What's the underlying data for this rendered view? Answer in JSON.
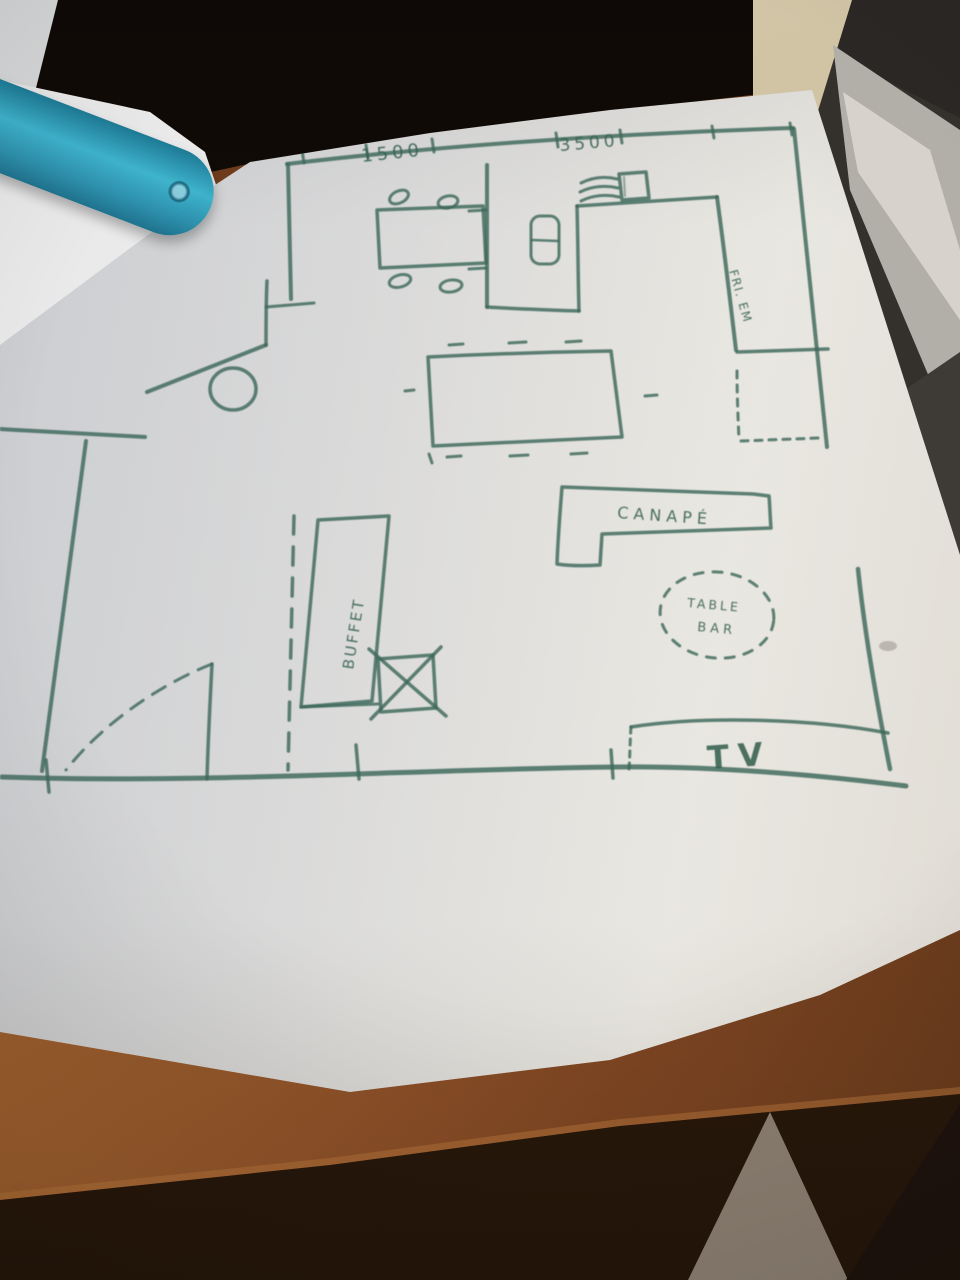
{
  "plan": {
    "ink_color": "#3D685A",
    "dimensions": {
      "top_left": "1500",
      "top_right": "3500"
    },
    "labels": {
      "fridge": "FRI. EM",
      "sofa": "CANAPÉ",
      "table_bar_line1": "TABLE",
      "table_bar_line2": "BAR",
      "buffet": "BUFFET",
      "tv": "TV"
    }
  },
  "scene": {
    "paper_color": "#E2E0DB",
    "wood_color": "#7C4420",
    "ruler_color": "#2CA9C9"
  }
}
